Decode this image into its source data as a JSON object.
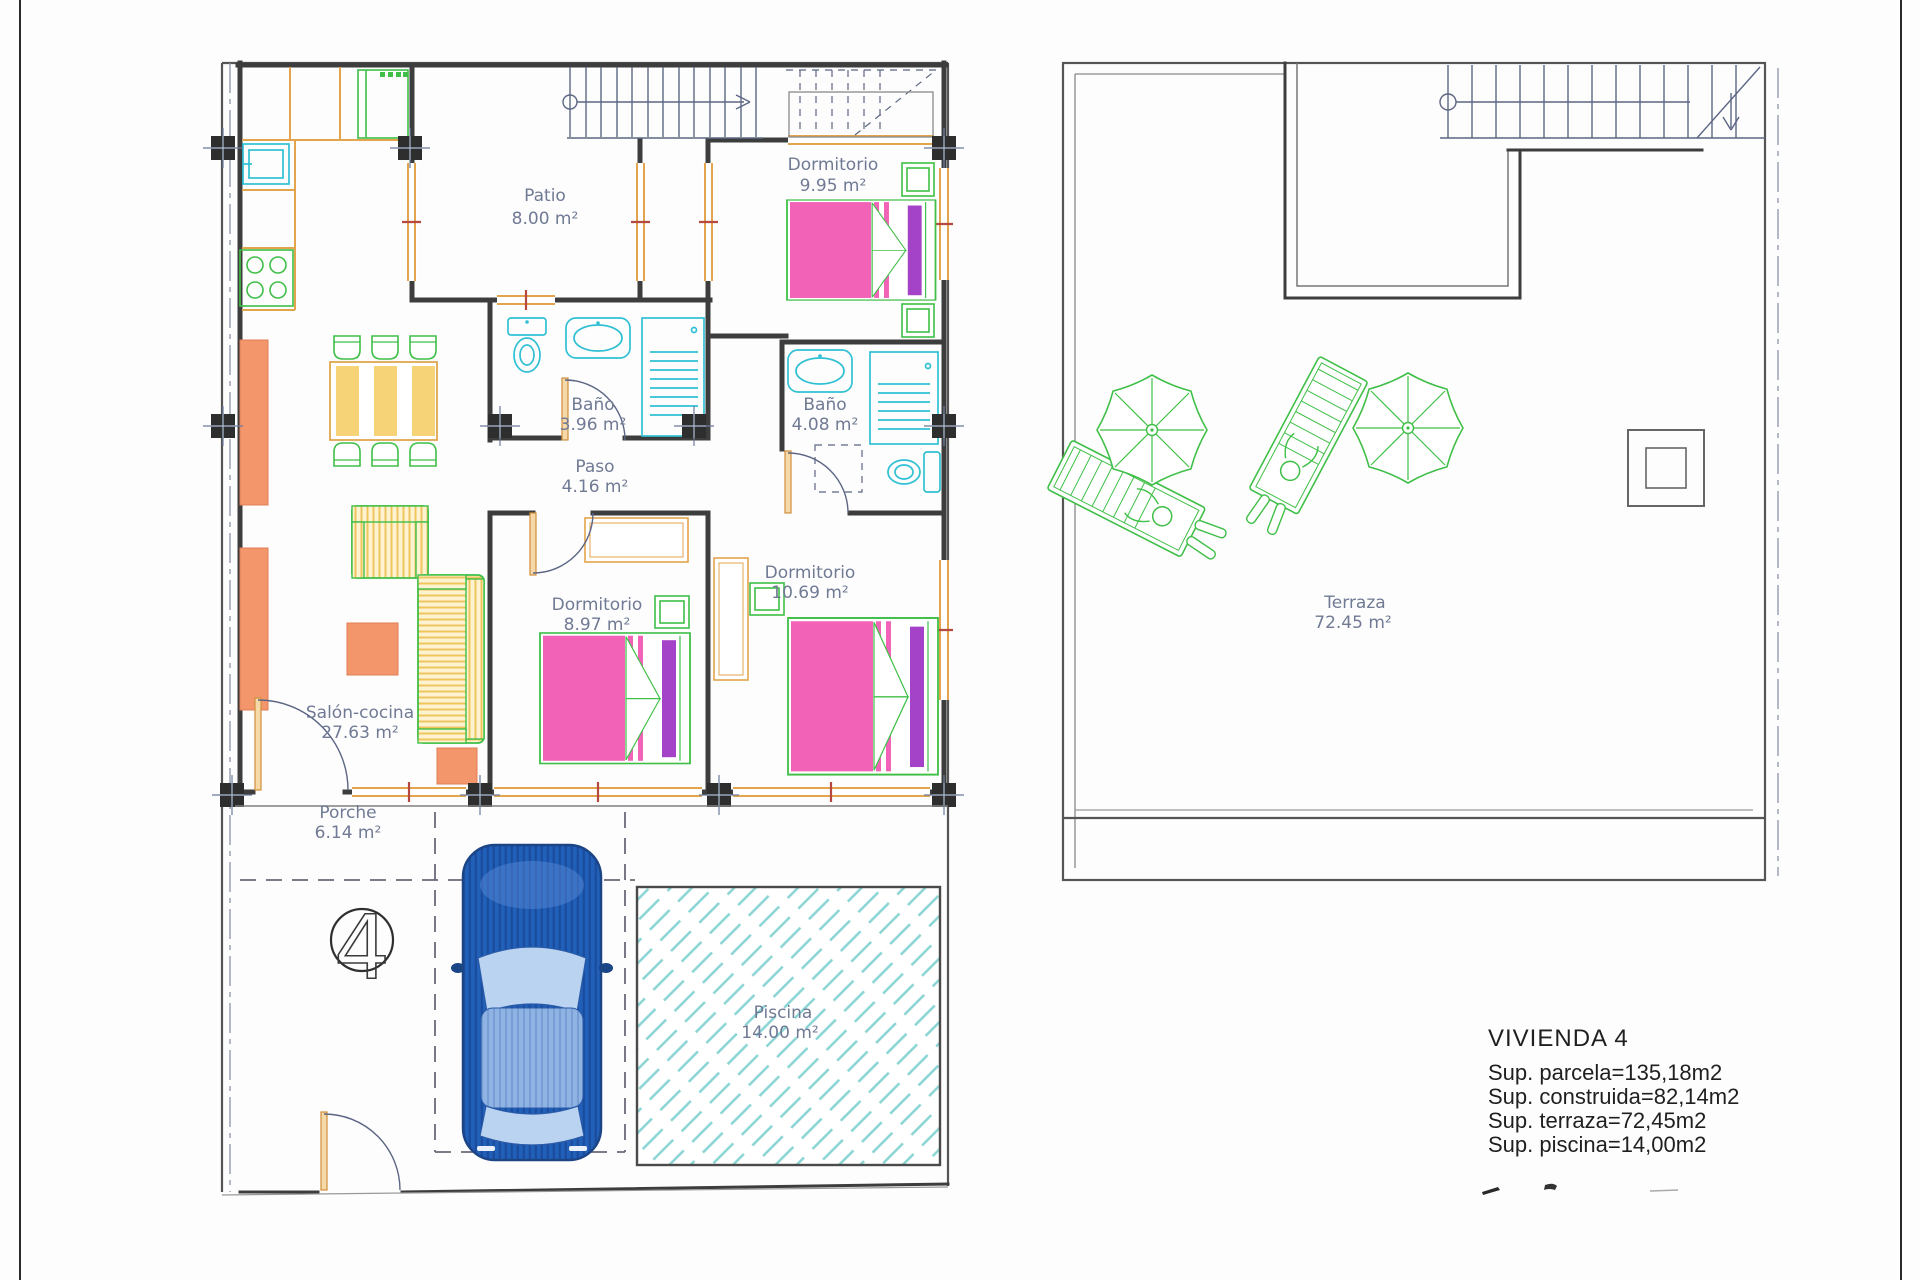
{
  "plans": {
    "ground_floor": {
      "rooms": {
        "patio": {
          "name": "Patio",
          "area": "8.00 m²"
        },
        "dormitorio1": {
          "name": "Dormitorio",
          "area": "9.95 m²"
        },
        "bano1": {
          "name": "Baño",
          "area": "3.96 m²"
        },
        "bano2": {
          "name": "Baño",
          "area": "4.08 m²"
        },
        "paso": {
          "name": "Paso",
          "area": "4.16 m²"
        },
        "dormitorio2": {
          "name": "Dormitorio",
          "area": "8.97 m²"
        },
        "dormitorio3": {
          "name": "Dormitorio",
          "area": "10.69 m²"
        },
        "salon": {
          "name": "Salón-cocina",
          "area": "27.63 m²"
        },
        "porche": {
          "name": "Porche",
          "area": "6.14 m²"
        },
        "piscina": {
          "name": "Piscina",
          "area": "14.00 m²"
        }
      },
      "unit_number": "4"
    },
    "roof": {
      "terraza": {
        "name": "Terraza",
        "area": "72.45 m²"
      }
    }
  },
  "summary": {
    "title": "VIVIENDA 4",
    "lines": [
      "Sup. parcela=135,18m2",
      "Sup. construida=82,14m2",
      "Sup. terraza=72,45m2",
      "Sup. piscina=14,00m2"
    ]
  },
  "colors": {
    "wall": "#3d3d3d",
    "annotation_blue": "#5c6684",
    "label_blue": "#707a94",
    "window_orange": "#e2a44c",
    "furniture_green": "#3fbf47",
    "fixture_cyan": "#2fc0d4",
    "accent_coral": "#f3966b",
    "accent_yellow": "#f6d377",
    "bed_pink": "#f263b8",
    "bed_purple": "#a543c8",
    "car_blue": "#2160b8",
    "pool_cyan": "#8ad4d4"
  }
}
